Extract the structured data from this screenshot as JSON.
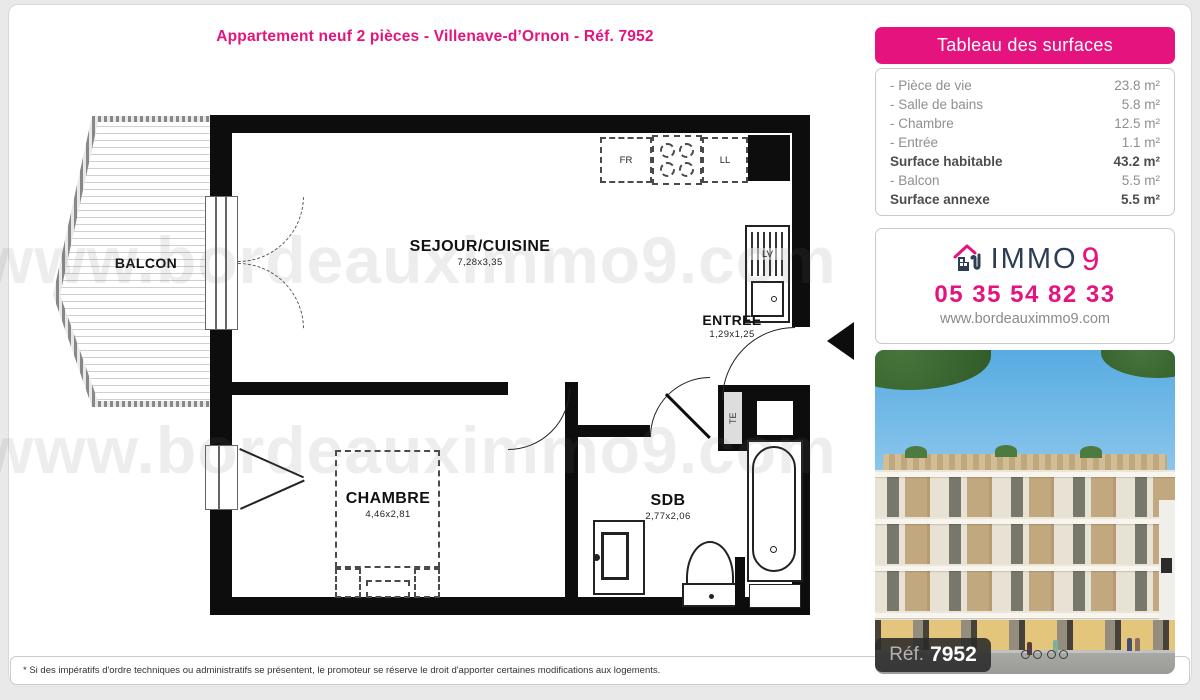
{
  "page": {
    "title": "Appartement neuf 2 pièces - Villenave-d’Ornon - Réf. 7952",
    "footnote": "* Si des impératifs d'ordre techniques ou administratifs se présentent, le promoteur se réserve le droit d'apporter certaines modifications aux logements."
  },
  "surfaces_panel": {
    "title": "Tableau des surfaces",
    "rows": [
      {
        "label": "- Pièce de vie",
        "value": "23.8 m²"
      },
      {
        "label": "- Salle de bains",
        "value": "5.8 m²"
      },
      {
        "label": "- Chambre",
        "value": "12.5 m²"
      },
      {
        "label": "- Entrée",
        "value": "1.1 m²"
      },
      {
        "label": "Surface habitable",
        "value": "43.2 m²"
      },
      {
        "label": "- Balcon",
        "value": "5.5 m²"
      },
      {
        "label": "Surface annexe",
        "value": "5.5 m²"
      }
    ]
  },
  "contact": {
    "brand": "IMMO",
    "brand_number": "9",
    "phone": "05 35 54 82 33",
    "website": "www.bordeauximmo9.com"
  },
  "photo": {
    "ref_label": "Réf.",
    "ref_number": "7952"
  },
  "floorplan": {
    "watermark": "www.bordeauximmo9.com",
    "living": {
      "name": "SEJOUR/CUISINE",
      "dims": "7,28x3,35"
    },
    "balcony": {
      "name": "BALCON"
    },
    "entry": {
      "name": "ENTREE",
      "dims": "1,29x1,25"
    },
    "bedroom": {
      "name": "CHAMBRE",
      "dims": "4,46x2,81"
    },
    "bath": {
      "name": "SDB",
      "dims": "2,77x2,06"
    },
    "fridge": "FR",
    "washer": "LL",
    "dishwasher": "LV",
    "electrical": "TE"
  },
  "colors": {
    "accent": "#e5137e",
    "navy": "#2d3d55"
  }
}
